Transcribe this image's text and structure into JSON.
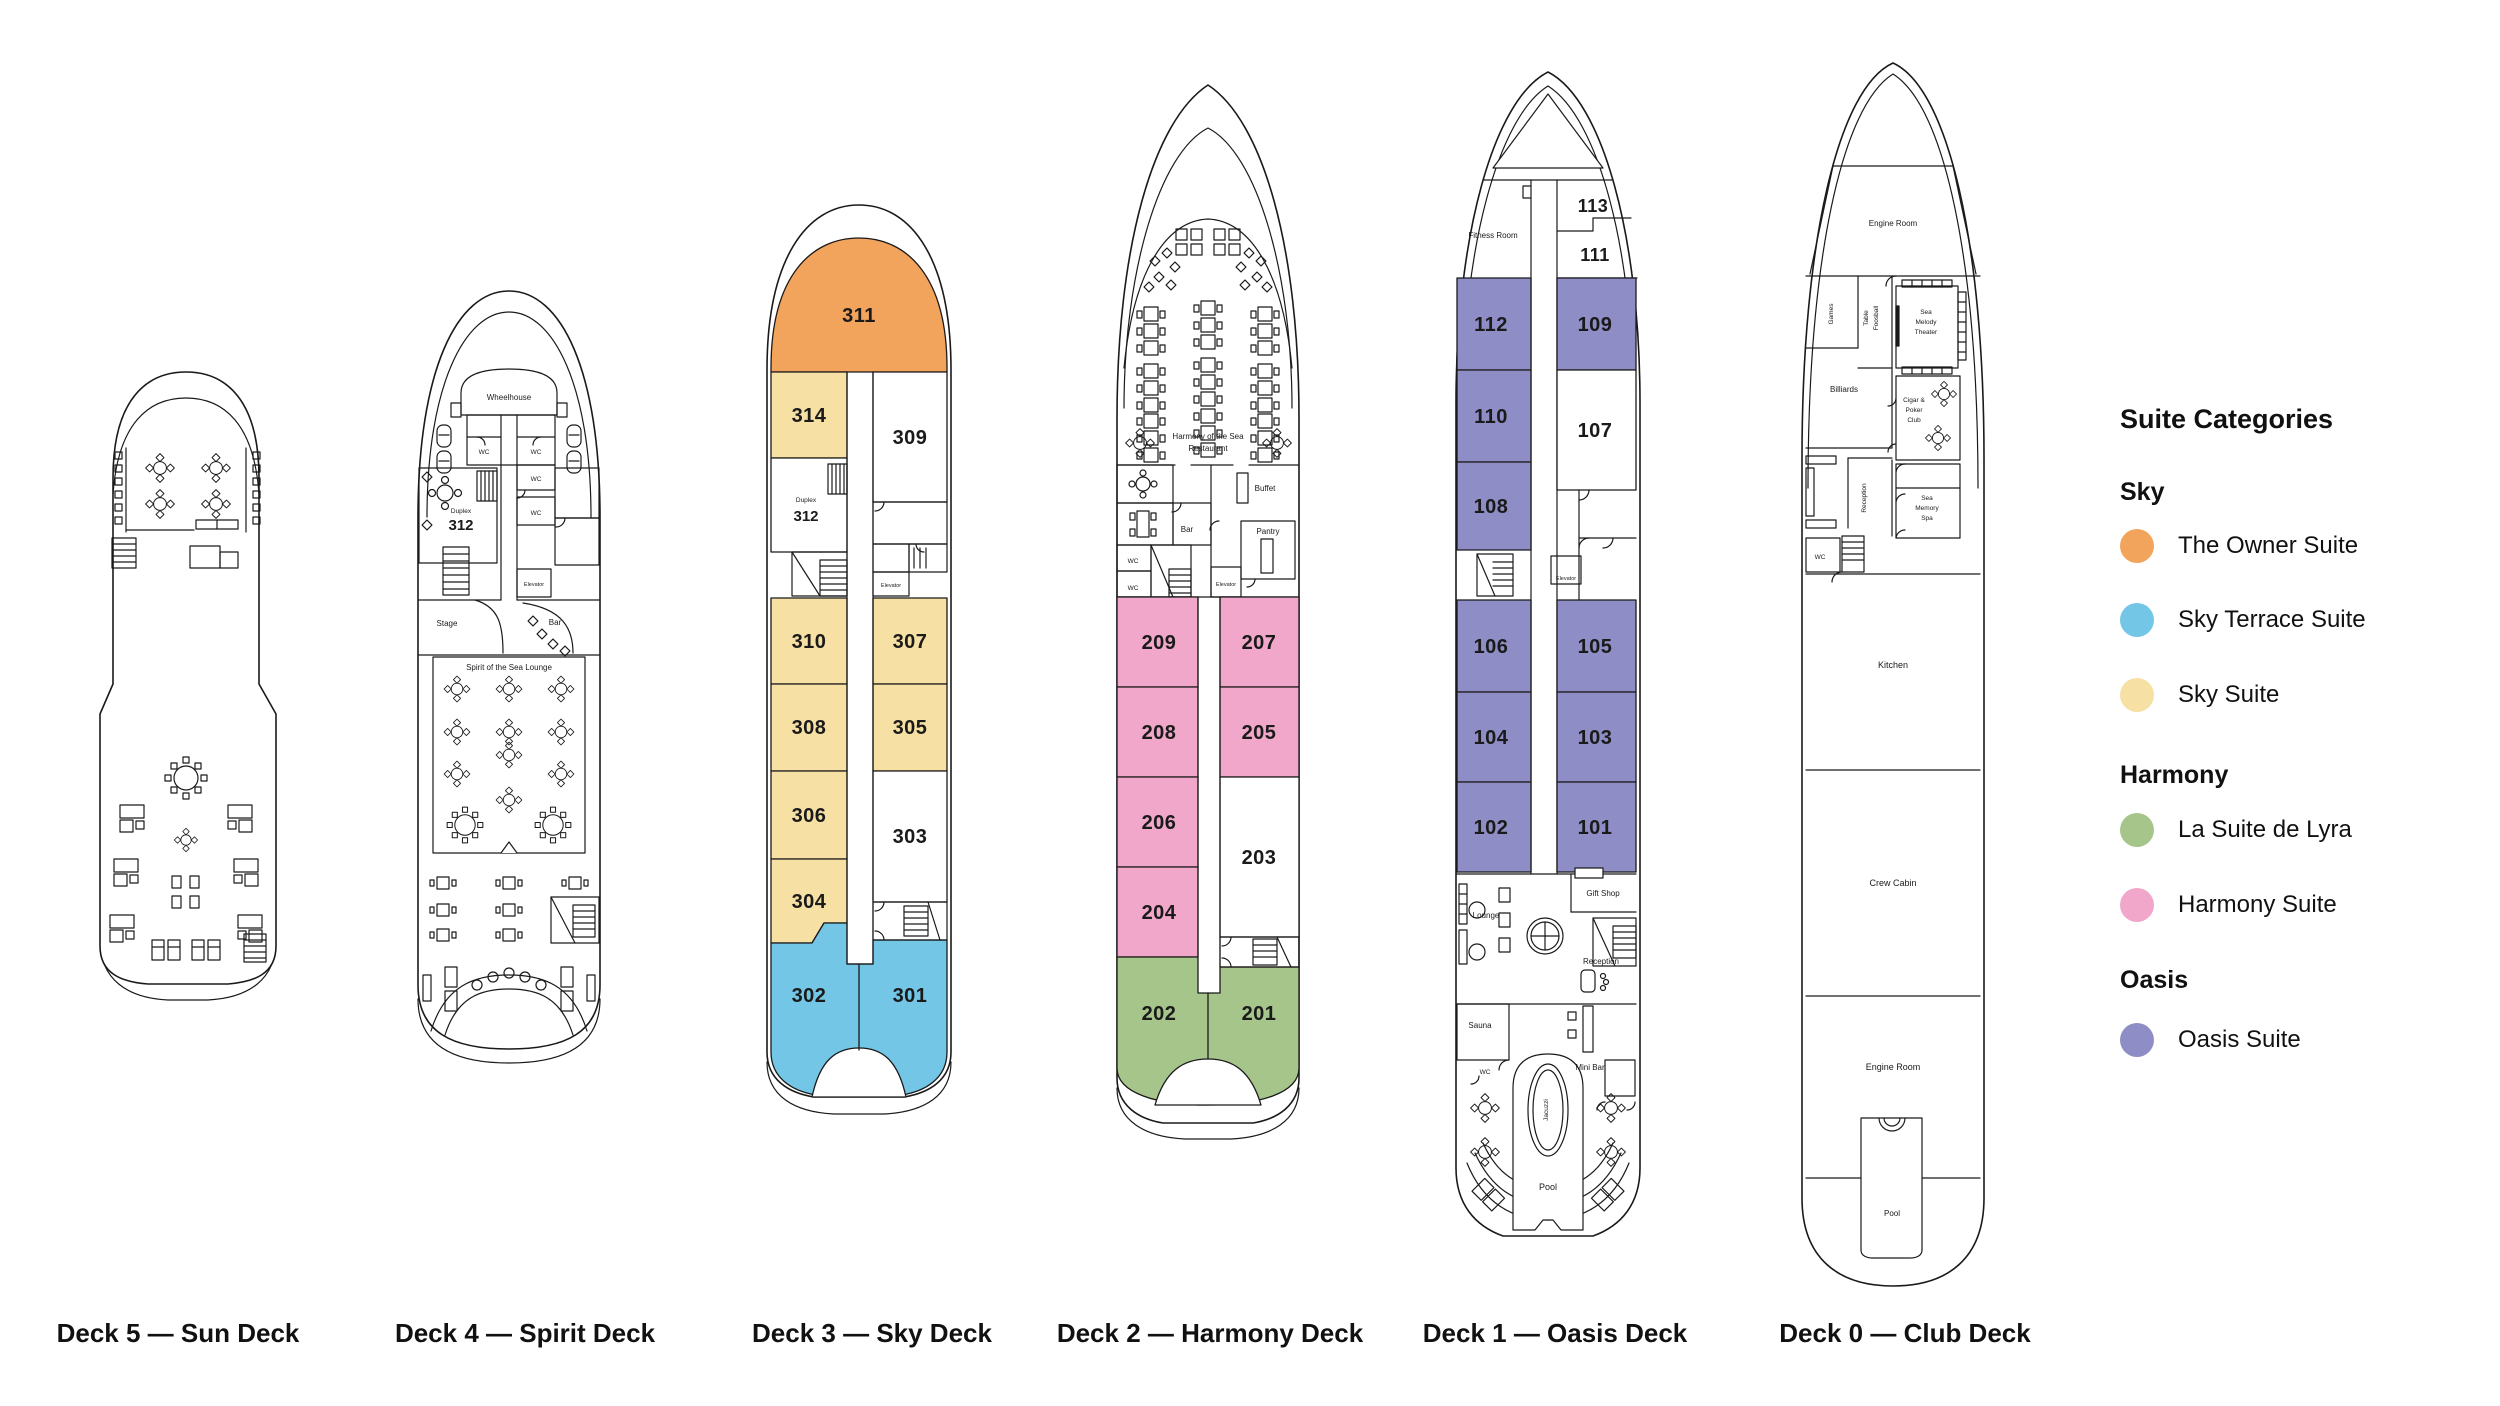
{
  "colors": {
    "owner_suite": "#F2A45C",
    "sky_terrace_suite": "#73C6E6",
    "sky_suite": "#F7E0A4",
    "la_suite_de_lyra": "#A6C58B",
    "harmony_suite": "#F0A7CA",
    "oasis_suite": "#8E8DC5",
    "outline": "#1A1A1A"
  },
  "legend": {
    "title": "Suite Categories",
    "groups": [
      {
        "name": "Sky",
        "items": [
          {
            "label": "The Owner Suite",
            "color": "#F2A45C"
          },
          {
            "label": "Sky Terrace Suite",
            "color": "#73C6E6"
          },
          {
            "label": "Sky Suite",
            "color": "#F7E0A4"
          }
        ]
      },
      {
        "name": "Harmony",
        "items": [
          {
            "label": "La Suite de Lyra",
            "color": "#A6C58B"
          },
          {
            "label": "Harmony Suite",
            "color": "#F0A7CA"
          }
        ]
      },
      {
        "name": "Oasis",
        "items": [
          {
            "label": "Oasis Suite",
            "color": "#8E8DC5"
          }
        ]
      }
    ]
  },
  "decks": [
    {
      "name": "deck-5-sun-deck",
      "label": "Deck 5 — Sun Deck"
    },
    {
      "name": "deck-4-spirit-deck",
      "label": "Deck 4 — Spirit Deck",
      "rooms": {
        "wheelhouse": "Wheelhouse",
        "wc": "WC",
        "duplex_label": "Duplex",
        "duplex_number": "312",
        "stage": "Stage",
        "bar": "Bar",
        "elevator": "Elevator",
        "lounge": "Spirit of the Sea Lounge"
      }
    },
    {
      "name": "deck-3-sky-deck",
      "label": "Deck 3 — Sky Deck",
      "rooms": {
        "duplex_label": "Duplex",
        "elevator": "Elevator"
      },
      "cabins": [
        {
          "number": "311",
          "category": "The Owner Suite"
        },
        {
          "number": "314",
          "category": "Sky Suite"
        },
        {
          "number": "309"
        },
        {
          "number": "312"
        },
        {
          "number": "310",
          "category": "Sky Suite"
        },
        {
          "number": "307",
          "category": "Sky Suite"
        },
        {
          "number": "308",
          "category": "Sky Suite"
        },
        {
          "number": "305",
          "category": "Sky Suite"
        },
        {
          "number": "306",
          "category": "Sky Suite"
        },
        {
          "number": "303"
        },
        {
          "number": "304",
          "category": "Sky Suite"
        },
        {
          "number": "302",
          "category": "Sky Terrace Suite"
        },
        {
          "number": "301",
          "category": "Sky Terrace Suite"
        }
      ]
    },
    {
      "name": "deck-2-harmony-deck",
      "label": "Deck 2 — Harmony Deck",
      "rooms": {
        "restaurant_line1": "Harmony of the Sea",
        "restaurant_line2": "Restaurant",
        "bar": "Bar",
        "buffet": "Buffet",
        "pantry": "Pantry",
        "wc": "WC",
        "elevator": "Elevator"
      },
      "cabins": [
        {
          "number": "209",
          "category": "Harmony Suite"
        },
        {
          "number": "207",
          "category": "Harmony Suite"
        },
        {
          "number": "208",
          "category": "Harmony Suite"
        },
        {
          "number": "205",
          "category": "Harmony Suite"
        },
        {
          "number": "206",
          "category": "Harmony Suite"
        },
        {
          "number": "203"
        },
        {
          "number": "204",
          "category": "Harmony Suite"
        },
        {
          "number": "202",
          "category": "La Suite de Lyra"
        },
        {
          "number": "201",
          "category": "La Suite de Lyra"
        }
      ]
    },
    {
      "name": "deck-1-oasis-deck",
      "label": "Deck 1 — Oasis Deck",
      "rooms": {
        "fitness": "Fitness Room",
        "elevator": "Elevator",
        "gift_shop": "Gift Shop",
        "lounge": "Lounge",
        "reception": "Reception",
        "sauna": "Sauna",
        "wc": "WC",
        "mini_bar": "Mini Bar",
        "jacuzzi": "Jacuzzi",
        "pool": "Pool"
      },
      "cabins": [
        {
          "number": "113"
        },
        {
          "number": "111"
        },
        {
          "number": "112",
          "category": "Oasis Suite"
        },
        {
          "number": "109",
          "category": "Oasis Suite"
        },
        {
          "number": "110",
          "category": "Oasis Suite"
        },
        {
          "number": "107"
        },
        {
          "number": "108",
          "category": "Oasis Suite"
        },
        {
          "number": "106",
          "category": "Oasis Suite"
        },
        {
          "number": "105",
          "category": "Oasis Suite"
        },
        {
          "number": "104",
          "category": "Oasis Suite"
        },
        {
          "number": "103",
          "category": "Oasis Suite"
        },
        {
          "number": "102",
          "category": "Oasis Suite"
        },
        {
          "number": "101",
          "category": "Oasis Suite"
        }
      ]
    },
    {
      "name": "deck-0-club-deck",
      "label": "Deck 0 — Club Deck",
      "rooms": {
        "engine_room": "Engine Room",
        "games": "Games",
        "foosball_line1": "Table",
        "foosball_line2": "Foosball",
        "theater_line1": "Sea",
        "theater_line2": "Melody",
        "theater_line3": "Theater",
        "billiards": "Billiards",
        "cigar_line1": "Cigar &",
        "cigar_line2": "Poker",
        "cigar_line3": "Club",
        "reception": "Reception",
        "spa_line1": "Sea",
        "spa_line2": "Memory",
        "spa_line3": "Spa",
        "wc": "WC",
        "kitchen": "Kitchen",
        "crew_cabin": "Crew Cabin",
        "engine_room_lower": "Engine Room",
        "pool": "Pool"
      }
    }
  ]
}
